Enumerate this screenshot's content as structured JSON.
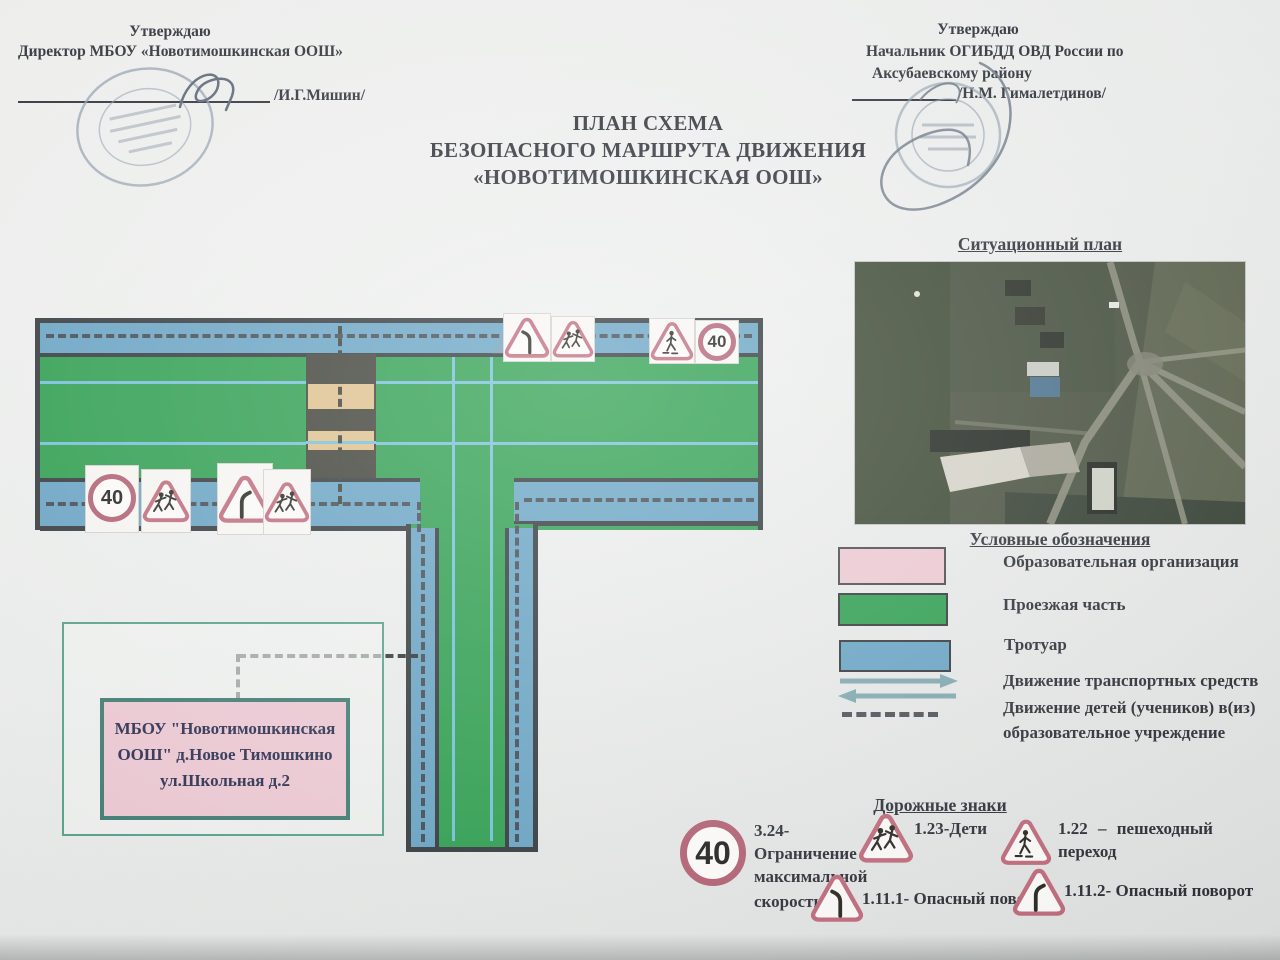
{
  "approvals": {
    "left": {
      "line1": "Утверждаю",
      "line2": "Директор МБОУ «Новотимошкинская ООШ»",
      "name": "/И.Г.Мишин/"
    },
    "right": {
      "line1": "Утверждаю",
      "line2": "Начальник ОГИБДД ОВД России по",
      "line3": "Аксубаевскому району",
      "name": "/Н.М. Гималетдинов/"
    }
  },
  "title": {
    "line1": "ПЛАН СХЕМА",
    "line2": "БЕЗОПАСНОГО МАРШРУТА ДВИЖЕНИЯ",
    "line3": "«НОВОТИМОШКИНСКАЯ ООШ»"
  },
  "situational": {
    "title": "Ситуационный план"
  },
  "school": {
    "line1": "МБОУ \"Новотимошкинская",
    "line2": "ООШ\"  д.Новое Тимошкино",
    "line3": "ул.Школьная д.2"
  },
  "legend": {
    "title": "Условные обозначения",
    "items": [
      {
        "label": "Образовательная организация",
        "color": "#eec9d4"
      },
      {
        "label": "Проезжая часть",
        "color": "#2b9e4d"
      },
      {
        "label": "Тротуар",
        "color": "#66a3c4"
      },
      {
        "label": "Движение транспортных средств"
      },
      {
        "line1": "Движение детей (учеников) в(из)",
        "line2": "образовательное учреждение"
      }
    ]
  },
  "road_signs": {
    "title": "Дорожные знаки",
    "speed": {
      "value": "40",
      "line1": "3.24-",
      "line2": "Ограничение",
      "line3": "максимальной",
      "line4": "скорости"
    },
    "children": {
      "label": "1.23-Дети"
    },
    "pedestrian": {
      "line1": "1.22 – пешеходный",
      "line2": "переход"
    },
    "curve1": {
      "label": "1.11.1- Опасный поворот"
    },
    "curve2": {
      "label": "1.11.2- Опасный поворот"
    }
  },
  "colors": {
    "road_green": "#2b9e4d",
    "sidewalk_blue": "#66a3c4",
    "school_pink": "#eec9d4",
    "sign_ring_red": "#b25f72",
    "crosswalk_dark": "#3b3e35",
    "crosswalk_stripe": "#dfc18c"
  }
}
